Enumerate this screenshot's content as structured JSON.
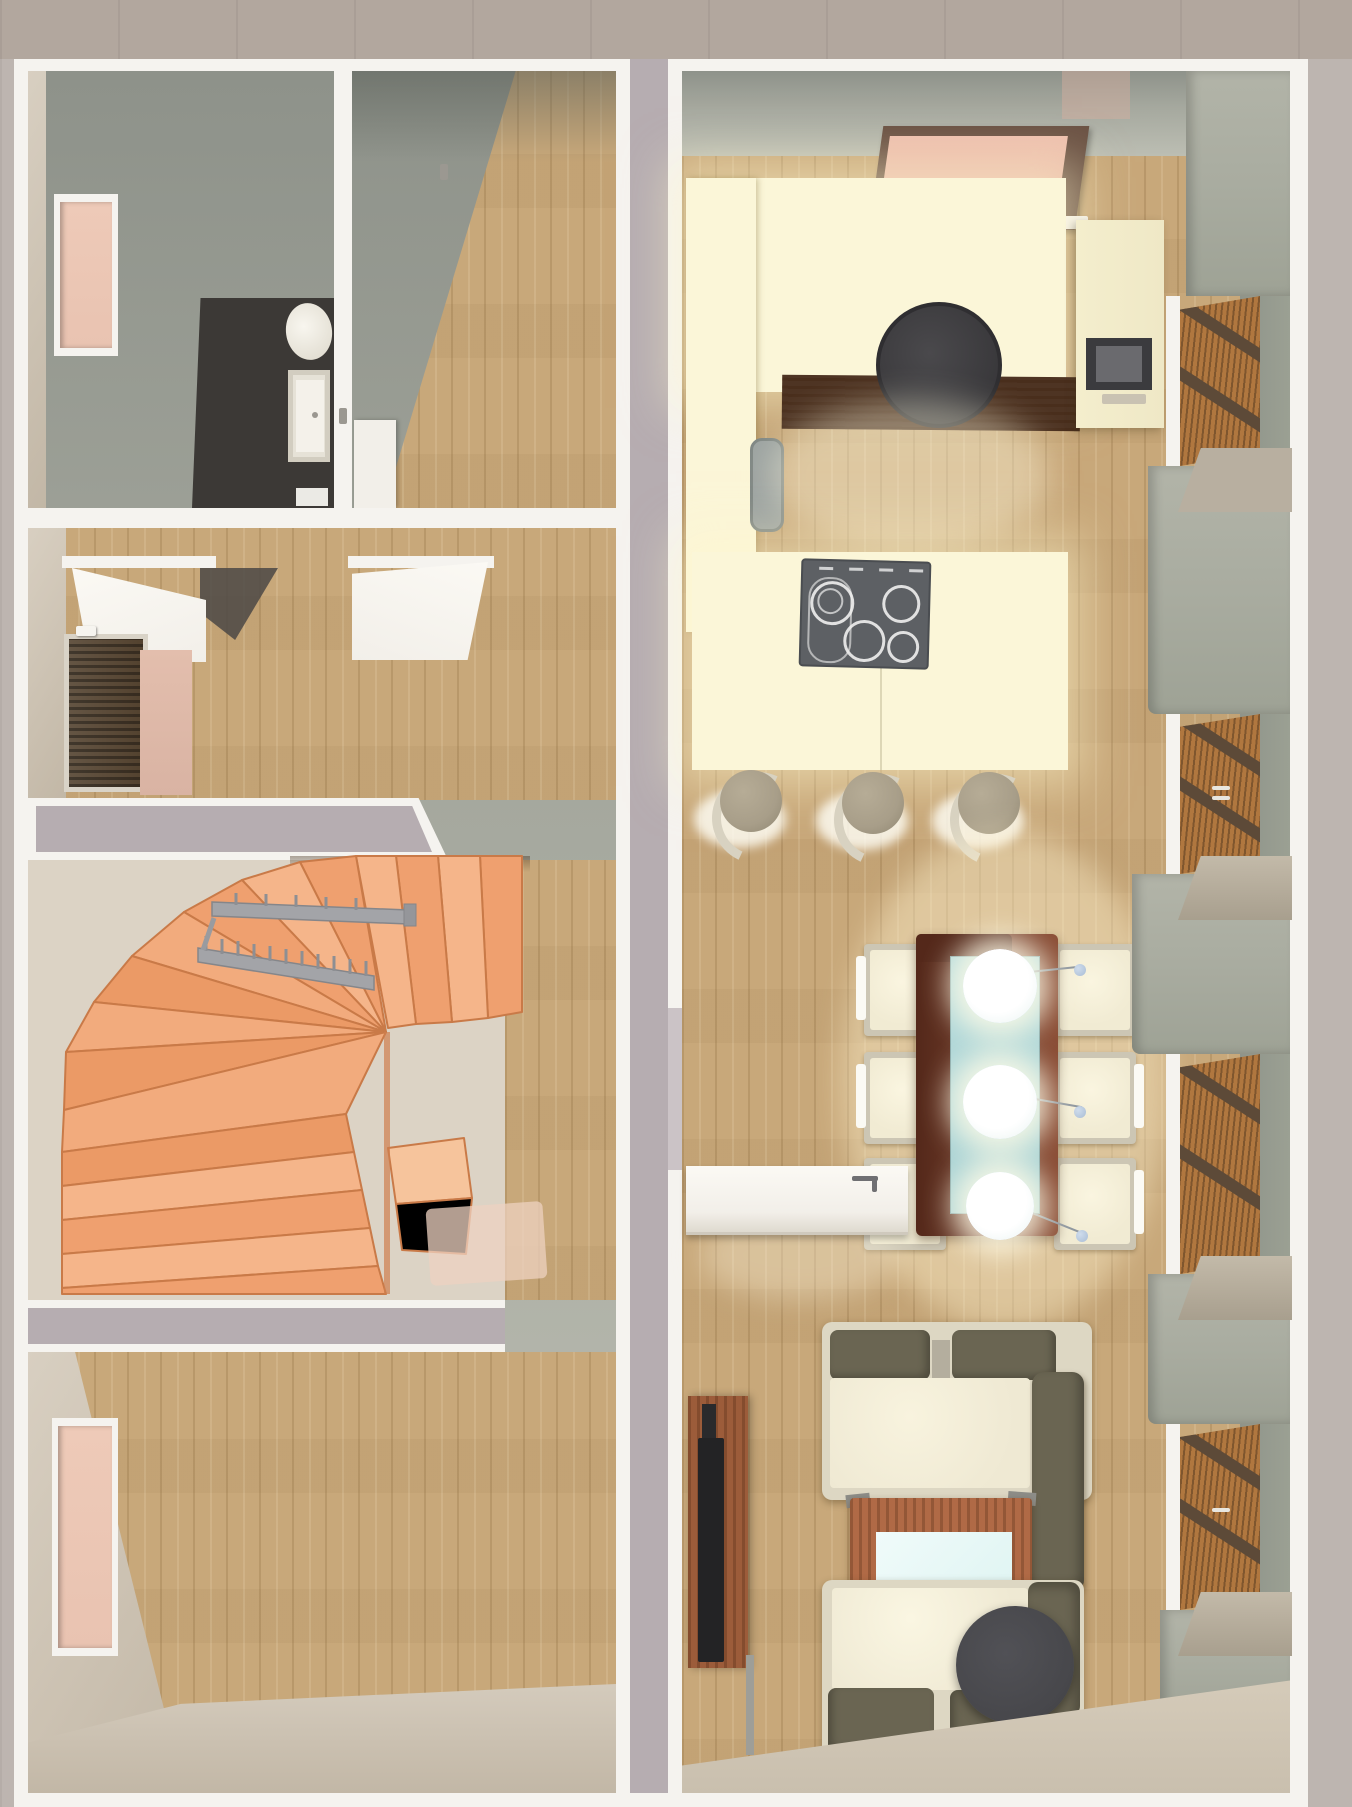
{
  "meta": {
    "view": "3d-floor-plan-top-down-render",
    "text_content": "none"
  },
  "palette": {
    "outside_ground": "#bdb5b0",
    "outside_top": "#b2a79e",
    "trim_white": "#f5f3ef",
    "party_wall": "#b6adb1",
    "wallface": "#a5a89e",
    "wallface_dark": "#8e928a",
    "wallface_light": "#bcbeb3",
    "wallface_beige": "#d8cfc1",
    "wallface_beige_dark": "#c2b7a6",
    "wood": "#c8a87a",
    "bath_floor": "#3c3936",
    "fixture_white": "#f2efe8",
    "stair": "#f2a97a",
    "stair_light": "#f7bd94",
    "stair_dark": "#cf7f4f",
    "landing_floor": "#dcd3c5",
    "rail": "#a3a4a8",
    "cream": "#efe8c6",
    "cream_bright": "#fbf6d8",
    "counter_wood_dark": "#4e3423",
    "hood": "#413f42",
    "cooktop": "#5d6064",
    "sink": "#9ca3a1",
    "walnut": "#6f3c2a",
    "walnut_dark": "#54281a",
    "glass_teal": "#a8d2d4",
    "chair_frame": "#ccc6b4",
    "chair_seat": "#f1ebd3",
    "stool_ring": "#d8d2c1",
    "stool_cushion": "#a89e89",
    "sofa_frame": "#ddd7c3",
    "sofa_seat": "#efe9d3",
    "olive": "#6a6552",
    "coffee_wood": "#b06a46",
    "glass_pale": "#def4f2",
    "tv_black": "#232325",
    "sideboard": "#9c5c3a",
    "pouf": "#47474b",
    "door_white": "#f2efe9",
    "front_door": "#53422f",
    "mat_pink": "#d9b3a3",
    "window_pink": "#e9c3b1",
    "skylight_pink": "#e5b3a2",
    "skylight_frame": "#6b5244",
    "shutter": "#b0773f",
    "shutter_frame": "#5d4a38",
    "sill": "#b8afa0",
    "pier": "#a9aca0",
    "sphere_blue": "#a9bdd5"
  },
  "rooms": [
    {
      "label": "bathroom",
      "furniture": [
        "toilet",
        "washbasin",
        "bath-mat",
        "window"
      ]
    },
    {
      "label": "top-room",
      "furniture": [
        "door"
      ]
    },
    {
      "label": "entry-hall",
      "furniture": [
        "front-door",
        "entry-mat",
        "open-door",
        "open-door"
      ]
    },
    {
      "label": "stairwell",
      "furniture": [
        "winder-staircase",
        "handrail"
      ]
    },
    {
      "label": "bottom-left-room",
      "furniture": [
        "window"
      ]
    },
    {
      "label": "kitchen",
      "furniture": [
        "skylight",
        "tall-cabinets",
        "wall-counter",
        "dark-wood-counter",
        "extractor-hood",
        "appliance-cabinet",
        "sink",
        "island-counter",
        "cooktop",
        "breakfast-bar",
        "bar-stool",
        "bar-stool",
        "bar-stool"
      ]
    },
    {
      "label": "dining-area",
      "furniture": [
        "dining-table",
        "glass-top",
        "pendant-light",
        "pendant-light",
        "pendant-light",
        "dining-chair",
        "dining-chair",
        "dining-chair",
        "dining-chair",
        "dining-chair",
        "dining-chair",
        "open-door"
      ]
    },
    {
      "label": "living-area",
      "furniture": [
        "tv-sideboard",
        "tv",
        "sofa",
        "coffee-table",
        "sofa",
        "floor-pouf"
      ]
    },
    {
      "label": "east-wall",
      "furniture": [
        "shuttered-window",
        "shuttered-window",
        "shuttered-window",
        "shuttered-window",
        "window-sill",
        "window-sill",
        "window-sill",
        "window-sill"
      ]
    }
  ]
}
